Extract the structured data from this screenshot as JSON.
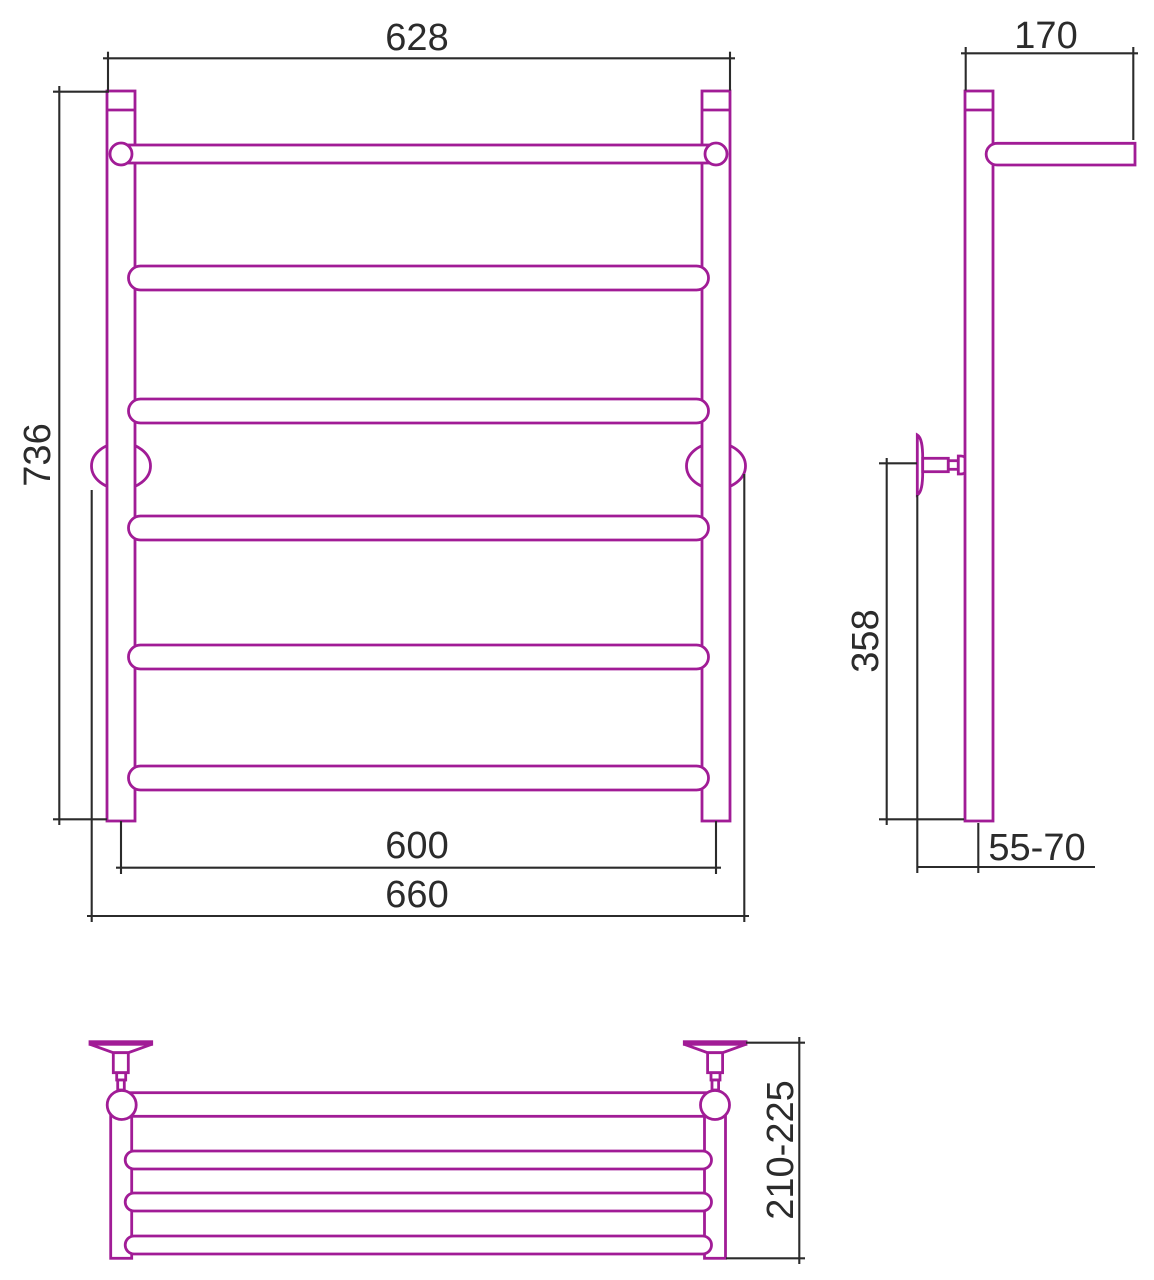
{
  "colors": {
    "drawing": "#A11C96",
    "dimension": "#2B2B2B",
    "background": "#FFFFFF"
  },
  "front_view": {
    "width_top": "628",
    "height": "736",
    "width_axes": "600",
    "width_overall": "660"
  },
  "side_view": {
    "depth_top_bar": "170",
    "height_lower": "358",
    "wall_clearance": "55-70"
  },
  "top_view": {
    "depth_overall": "210-225"
  }
}
